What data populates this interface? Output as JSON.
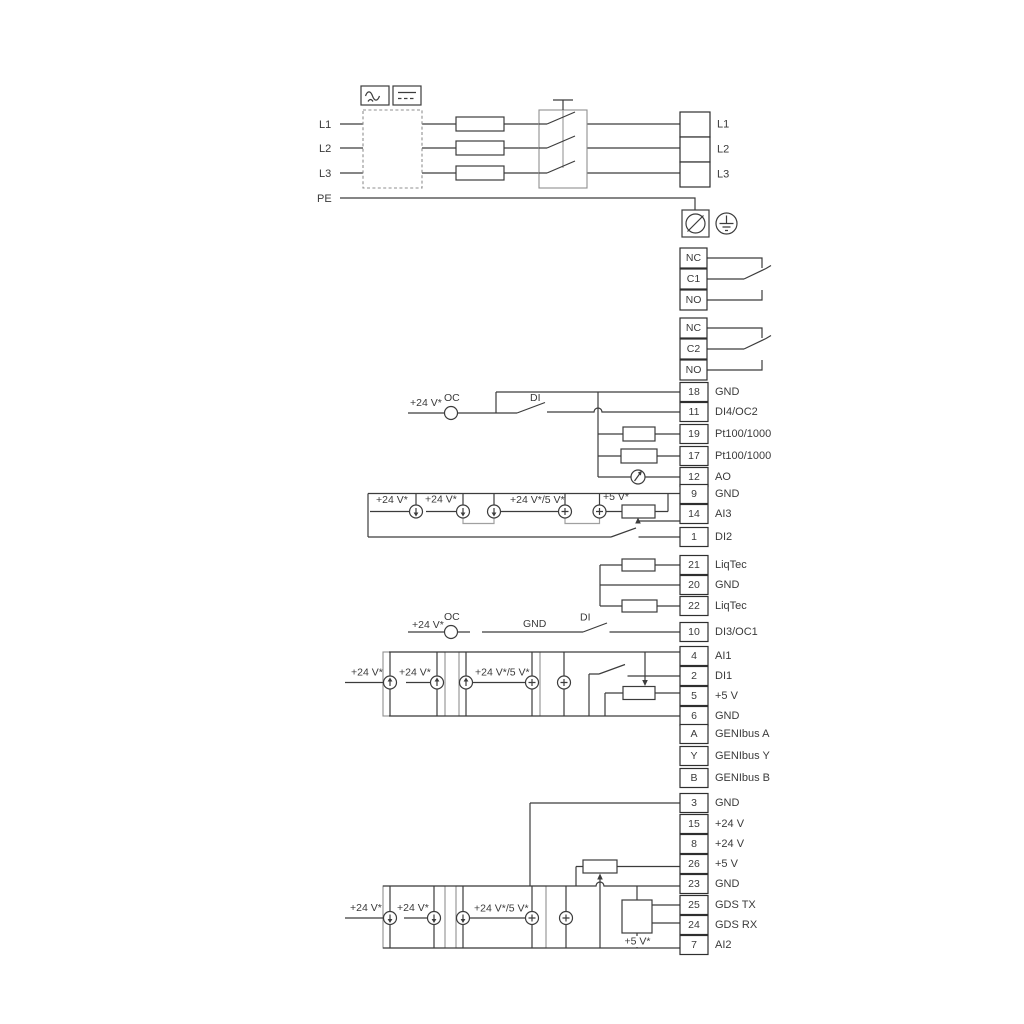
{
  "diagram_title": "Drive wiring diagram",
  "power": {
    "inputs": [
      "L1",
      "L2",
      "L3",
      "PE"
    ],
    "outputs": [
      {
        "num": "",
        "label": "L1"
      },
      {
        "num": "",
        "label": "L2"
      },
      {
        "num": "",
        "label": "L3"
      }
    ]
  },
  "relays": {
    "relay1": [
      {
        "num": "NC",
        "label": ""
      },
      {
        "num": "C1",
        "label": ""
      },
      {
        "num": "NO",
        "label": ""
      }
    ],
    "relay2": [
      {
        "num": "NC",
        "label": ""
      },
      {
        "num": "C2",
        "label": ""
      },
      {
        "num": "NO",
        "label": ""
      }
    ]
  },
  "terminals": {
    "io_top": [
      {
        "num": "18",
        "label": "GND"
      },
      {
        "num": "11",
        "label": "DI4/OC2"
      },
      {
        "num": "19",
        "label": "Pt100/1000"
      },
      {
        "num": "17",
        "label": "Pt100/1000"
      },
      {
        "num": "12",
        "label": "AO"
      },
      {
        "num": "9",
        "label": "GND"
      },
      {
        "num": "14",
        "label": "AI3"
      },
      {
        "num": "1",
        "label": "DI2"
      }
    ],
    "liqtec": [
      {
        "num": "21",
        "label": "LiqTec"
      },
      {
        "num": "20",
        "label": "GND"
      },
      {
        "num": "22",
        "label": "LiqTec"
      }
    ],
    "io_mid": [
      {
        "num": "10",
        "label": "DI3/OC1"
      },
      {
        "num": "4",
        "label": "AI1"
      },
      {
        "num": "2",
        "label": "DI1"
      },
      {
        "num": "5",
        "label": "+5 V"
      },
      {
        "num": "6",
        "label": "GND"
      }
    ],
    "genibus": [
      {
        "num": "A",
        "label": "GENIbus A"
      },
      {
        "num": "Y",
        "label": "GENIbus Y"
      },
      {
        "num": "B",
        "label": "GENIbus B"
      }
    ],
    "io_bottom": [
      {
        "num": "3",
        "label": "GND"
      },
      {
        "num": "15",
        "label": "+24 V"
      },
      {
        "num": "8",
        "label": "+24 V"
      },
      {
        "num": "26",
        "label": "+5 V"
      },
      {
        "num": "23",
        "label": "GND"
      },
      {
        "num": "25",
        "label": "GDS TX"
      },
      {
        "num": "24",
        "label": "GDS RX"
      },
      {
        "num": "7",
        "label": "AI2"
      }
    ]
  },
  "annotations": {
    "v24": "+24 V*",
    "v24_5": "+24 V*/5 V*",
    "v5": "+5 V*",
    "oc": "OC",
    "di": "DI",
    "gnd": "GND"
  },
  "colors": {
    "wire": "#3c3c3c",
    "aux_gray": "#a0a0a0",
    "background": "#ffffff"
  }
}
